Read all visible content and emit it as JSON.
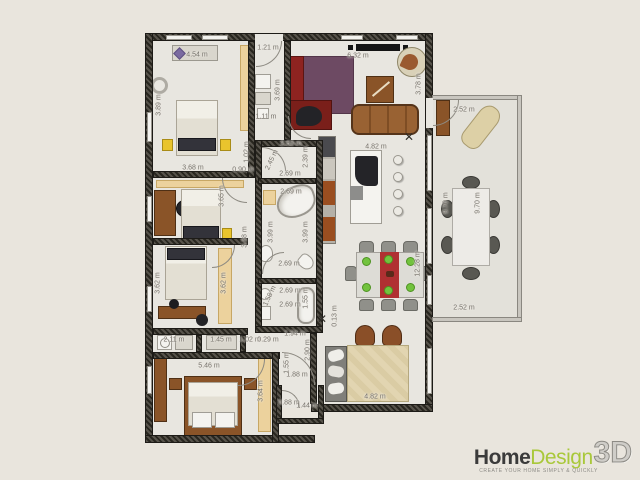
{
  "branding": {
    "logo": {
      "home": "Home",
      "design": "Design",
      "three_d": "3D",
      "tagline": "CREATE YOUR HOME SIMPLY & QUICKLY"
    }
  },
  "colors": {
    "background": "#e9e5dd",
    "wall": "#2b2923",
    "floor": "#e8e6e0",
    "accent_green": "#a9c83a",
    "rug_purple": "#6d4a63",
    "tv_unit_red": "#8e2320",
    "sofa_brown": "#996233",
    "plate_green": "#72c33e",
    "nightstand_yellow": "#e9c42d",
    "wardrobe_tan": "#ecd29d",
    "dimension_text": "#75716a"
  },
  "plan": {
    "unit": "m",
    "dimension_labels": [
      {
        "text": "4.54 m",
        "x": 197,
        "y": 55,
        "rot": 0
      },
      {
        "text": "1.21 m",
        "x": 268,
        "y": 48,
        "rot": 0
      },
      {
        "text": "6.32 m",
        "x": 358,
        "y": 56,
        "rot": 0
      },
      {
        "text": "3.89 m",
        "x": 159,
        "y": 105,
        "rot": -90
      },
      {
        "text": "3.69 m",
        "x": 278,
        "y": 90,
        "rot": -90
      },
      {
        "text": "1.11 m",
        "x": 266,
        "y": 117,
        "rot": 0
      },
      {
        "text": "3.78 m",
        "x": 419,
        "y": 84,
        "rot": -90
      },
      {
        "text": "2.52 m",
        "x": 464,
        "y": 110,
        "rot": 0
      },
      {
        "text": "9.70 m",
        "x": 446,
        "y": 203,
        "rot": -90
      },
      {
        "text": "9.70 m",
        "x": 478,
        "y": 203,
        "rot": -90
      },
      {
        "text": "2.52 m",
        "x": 464,
        "y": 308,
        "rot": 0
      },
      {
        "text": "3.68 m",
        "x": 193,
        "y": 168,
        "rot": 0
      },
      {
        "text": "0.90 m",
        "x": 243,
        "y": 170,
        "rot": 0
      },
      {
        "text": "1.02 m",
        "x": 247,
        "y": 152,
        "rot": -90
      },
      {
        "text": "2.63 m",
        "x": 291,
        "y": 144,
        "rot": 0
      },
      {
        "text": "2.39 m",
        "x": 306,
        "y": 157,
        "rot": -90
      },
      {
        "text": "2.45 m",
        "x": 272,
        "y": 160,
        "rot": -65
      },
      {
        "text": "2.69 m",
        "x": 290,
        "y": 174,
        "rot": 0
      },
      {
        "text": "2.69 m",
        "x": 291,
        "y": 192,
        "rot": 0
      },
      {
        "text": "3.99 m",
        "x": 271,
        "y": 232,
        "rot": -90
      },
      {
        "text": "3.99 m",
        "x": 306,
        "y": 232,
        "rot": -90
      },
      {
        "text": "2.69 m",
        "x": 289,
        "y": 264,
        "rot": 0
      },
      {
        "text": "2.69 m",
        "x": 290,
        "y": 291,
        "rot": 0
      },
      {
        "text": "1.58 m",
        "x": 270,
        "y": 296,
        "rot": -65
      },
      {
        "text": "1.55 m",
        "x": 306,
        "y": 298,
        "rot": -90
      },
      {
        "text": "2.69 m",
        "x": 290,
        "y": 305,
        "rot": 0
      },
      {
        "text": "3.65 m",
        "x": 222,
        "y": 196,
        "rot": -90
      },
      {
        "text": "3.38 m",
        "x": 245,
        "y": 237,
        "rot": -90
      },
      {
        "text": "4.82 m",
        "x": 376,
        "y": 147,
        "rot": 0
      },
      {
        "text": "12.28 m",
        "x": 418,
        "y": 264,
        "rot": -90
      },
      {
        "text": "0.13 m",
        "x": 335,
        "y": 316,
        "rot": -90
      },
      {
        "text": "3.62 m",
        "x": 158,
        "y": 283,
        "rot": -90
      },
      {
        "text": "3.62 m",
        "x": 224,
        "y": 283,
        "rot": -90
      },
      {
        "text": "2.11 m",
        "x": 174,
        "y": 340,
        "rot": 0
      },
      {
        "text": "1.45 m",
        "x": 221,
        "y": 340,
        "rot": 0
      },
      {
        "text": "1.02 m",
        "x": 250,
        "y": 340,
        "rot": 0
      },
      {
        "text": "0.29 m",
        "x": 268,
        "y": 340,
        "rot": 0
      },
      {
        "text": "1.94 m",
        "x": 295,
        "y": 334,
        "rot": 0
      },
      {
        "text": "2.90 m",
        "x": 308,
        "y": 350,
        "rot": -90
      },
      {
        "text": "1.55 m",
        "x": 287,
        "y": 363,
        "rot": -90
      },
      {
        "text": "1.88 m",
        "x": 297,
        "y": 375,
        "rot": 0
      },
      {
        "text": "5.46 m",
        "x": 209,
        "y": 366,
        "rot": 0
      },
      {
        "text": "3.64 m",
        "x": 261,
        "y": 391,
        "rot": -90
      },
      {
        "text": "4.82 m",
        "x": 375,
        "y": 397,
        "rot": 0
      },
      {
        "text": "0.88 m",
        "x": 289,
        "y": 403,
        "rot": 0
      },
      {
        "text": "1.44 m",
        "x": 307,
        "y": 406,
        "rot": 0
      }
    ],
    "furniture_items": [
      "double-bed",
      "nightstand",
      "wardrobe",
      "round-mirror",
      "dresser",
      "shelf",
      "desk",
      "office-chair",
      "single-bed",
      "table-lamp",
      "washing-machine",
      "tv-screen",
      "tv-wall-unit",
      "area-rug",
      "sofa",
      "coffee-table",
      "ball-chair",
      "kitchen-cabinets",
      "kitchen-island",
      "sink",
      "bar-stool",
      "dining-table",
      "dining-chair",
      "table-runner",
      "plate",
      "armchair",
      "sofa-bed",
      "headboard",
      "corner-bathtub",
      "bathtub",
      "washbasin",
      "toilet",
      "ceiling-fan",
      "terrace-table",
      "terrace-chair",
      "lounge-chair",
      "terrace-cabinet"
    ]
  }
}
